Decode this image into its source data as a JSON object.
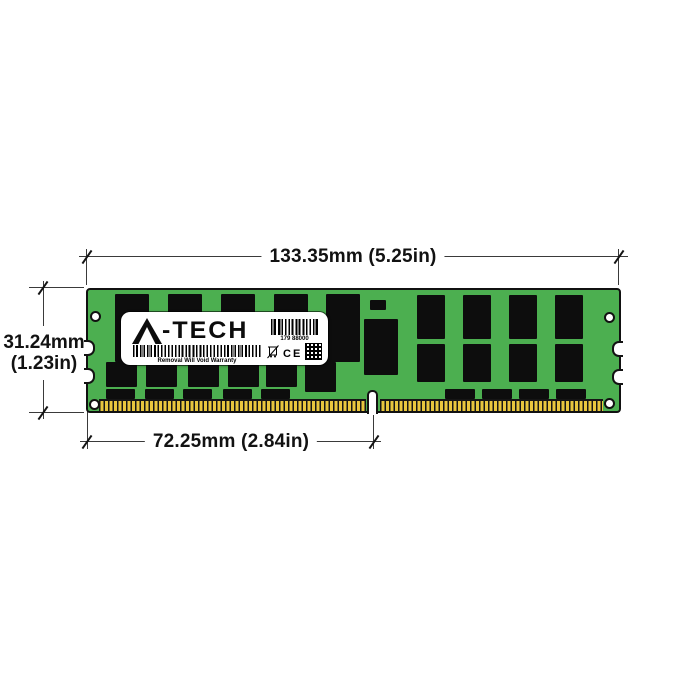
{
  "annotations": {
    "width_label": "133.35mm (5.25in)",
    "height_label_mm": "31.24mm",
    "height_label_in": "(1.23in)",
    "pin_span_label": "72.25mm (2.84in)"
  },
  "module": {
    "label": {
      "brand": "A-TECH",
      "barcode_number": "179 88000",
      "warranty_text": "Removal Will Void Warranty",
      "ce_mark": "CE"
    },
    "colors": {
      "pcb_green": "#4caf50",
      "chip_black": "#0d0d0d",
      "pin_gold": "#e8c63e",
      "outline": "#111111"
    }
  },
  "figure": {
    "type": "dimension-diagram",
    "subject": "server memory module (RDIMM)",
    "chips": [
      [
        27,
        4,
        34,
        68
      ],
      [
        80,
        4,
        34,
        68
      ],
      [
        133,
        4,
        34,
        68
      ],
      [
        186,
        4,
        34,
        68
      ],
      [
        238,
        4,
        34,
        68
      ],
      [
        18,
        72,
        31,
        25
      ],
      [
        58,
        72,
        31,
        25
      ],
      [
        100,
        72,
        31,
        25
      ],
      [
        140,
        72,
        31,
        25
      ],
      [
        178,
        72,
        31,
        25
      ],
      [
        217,
        72,
        31,
        30
      ],
      [
        18,
        99,
        29,
        10
      ],
      [
        57,
        99,
        29,
        10
      ],
      [
        95,
        99,
        29,
        10
      ],
      [
        135,
        99,
        29,
        10
      ],
      [
        173,
        99,
        29,
        10
      ],
      [
        282,
        10,
        16,
        10
      ],
      [
        276,
        29,
        34,
        56
      ],
      [
        329,
        5,
        28,
        44
      ],
      [
        375,
        5,
        28,
        44
      ],
      [
        421,
        5,
        28,
        44
      ],
      [
        467,
        5,
        28,
        44
      ],
      [
        329,
        54,
        28,
        38
      ],
      [
        375,
        54,
        28,
        38
      ],
      [
        421,
        54,
        28,
        38
      ],
      [
        467,
        54,
        28,
        38
      ],
      [
        357,
        99,
        30,
        10
      ],
      [
        394,
        99,
        30,
        10
      ],
      [
        431,
        99,
        30,
        10
      ],
      [
        468,
        99,
        30,
        10
      ]
    ]
  }
}
